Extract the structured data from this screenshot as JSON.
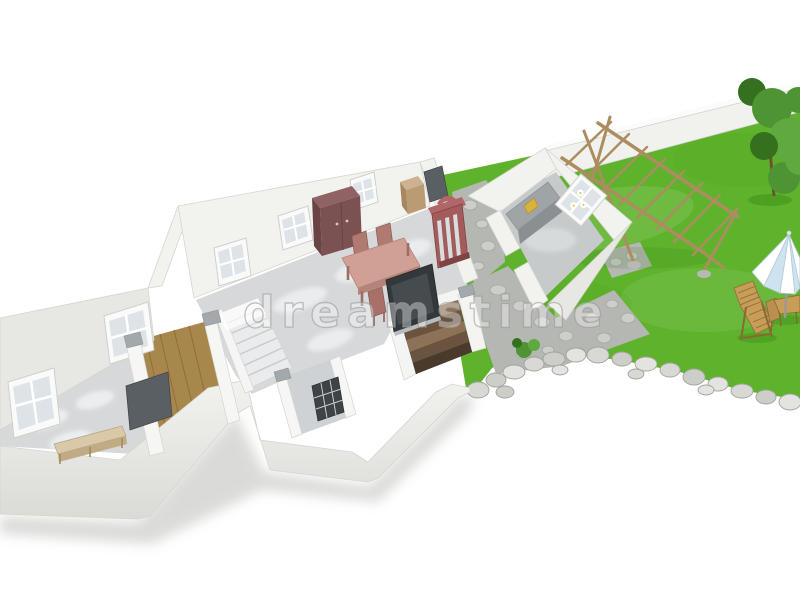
{
  "image": {
    "type": "3d-architectural-render",
    "subject": "Cutaway 3D floor plan of a furnished one-floor home with a walled garden",
    "width": 800,
    "height": 600
  },
  "watermark": {
    "text": "dreamstime"
  },
  "palette": {
    "background": "#ffffff",
    "grass": "#5fb32c",
    "grassDark": "#2f7d12",
    "boundaryWall": "#f1f1ee",
    "boundaryWallTop": "#fbfbfa",
    "houseWall": "#f2f2ef",
    "houseWallShade": "#e7e7e3",
    "wallEdge": "#d5d5d0",
    "marbleFloor": "#d6d8da",
    "marbleLight": "#eef0f2",
    "woodFloor": "#a8874d",
    "woodFloorLine": "#8d6f3c",
    "stonePath": "#b4b7b2",
    "cobble": "#ccceca",
    "cobbleEdge": "#9b9d99",
    "rock": "#d8d8d4",
    "rockEdge": "#a3a39e",
    "pergolaWood": "#ab8d60",
    "loungeWood": "#c89d58",
    "loungeWoodDark": "#97743a",
    "umbrellaWhite": "#ffffff",
    "umbrellaBlue": "#cfe2f0",
    "umbrellaEdge": "#b5c9d6",
    "bushGreen": "#4e9434",
    "bushGreenDark": "#35701f",
    "bushGreenLight": "#5fa940",
    "wardrobeMaroon": "#7b5151",
    "wardrobeMaroonTop": "#8f6363",
    "wardrobeMaroonSide": "#6a4444",
    "sideboardWood": "#cdb190",
    "tableSalmon": "#cfa093",
    "tableSalmonDark": "#b5837a",
    "chairSalmon": "#b07a70",
    "cabinetBrick": "#a35b5b",
    "cabinetBrickLight": "#b16767",
    "cabinetBrickDark": "#7e4343",
    "tvDark": "#33383b",
    "tvScreen": "#454b4f",
    "counterGray": "#9fa5a7",
    "counterGrayDark": "#8a9092",
    "basementStep": "#8d7257",
    "basementStepDark": "#6b543f",
    "basementPit": "#2e2620",
    "doorGray": "#5a5f63",
    "benchWood": "#d9c9a8",
    "benchWoodDark": "#c0ab84",
    "windowPane": "#dde3e7",
    "windowFrame": "#fafafa",
    "capGray": "#a2a8ac",
    "stairWhite": "#e9ebec",
    "stairLine": "#c6cacc",
    "shadow": "#bdbdb9",
    "itemYellow": "#d9b13c"
  },
  "garden": {
    "objects": [
      "lawn",
      "boundary-wall",
      "wooden-pergola",
      "stone-path",
      "rock-border",
      "shrub",
      "lounge-chair",
      "parasol",
      "garden-table-and-chairs"
    ]
  },
  "house": {
    "rooms": [
      "utility-room",
      "bedroom",
      "staircase-hall",
      "living-dining-room",
      "small-room",
      "basement-stairwell",
      "kitchen"
    ],
    "furniture": [
      "bench",
      "wardrobe",
      "sideboard",
      "dining-table",
      "dining-chairs",
      "display-cabinet",
      "tv-panel",
      "kitchen-counter"
    ],
    "features": [
      "windows",
      "doors",
      "interior-stairs",
      "wall-cut-caps"
    ]
  }
}
